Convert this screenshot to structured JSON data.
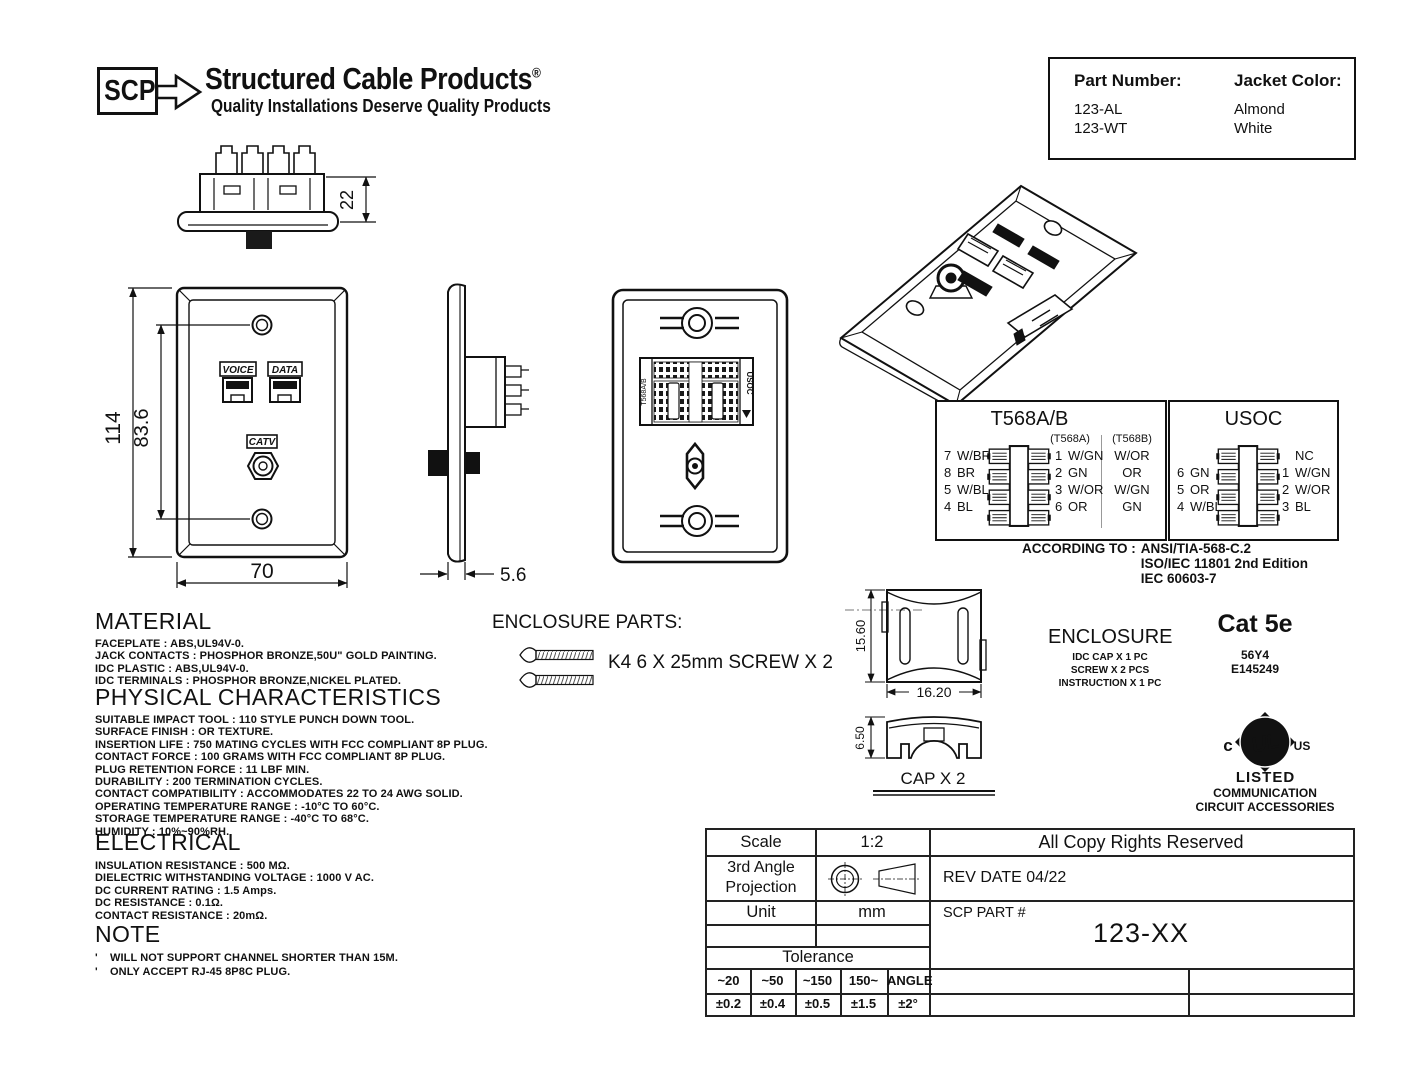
{
  "logo": {
    "abbr": "SCP",
    "title": "Structured Cable Products",
    "registered": "®",
    "tagline": "Quality Installations Deserve Quality Products"
  },
  "part_table": {
    "col1": "Part Number:",
    "col2": "Jacket Color:",
    "rows": [
      {
        "part": "123-AL",
        "color": "Almond"
      },
      {
        "part": "123-WT",
        "color": "White"
      }
    ]
  },
  "dims": {
    "depth": "22",
    "height": "114",
    "screw_spacing": "83.6",
    "width": "70",
    "thickness": "5.6",
    "cap_h": "15.60",
    "cap_w": "16.20",
    "cap_d": "6.50"
  },
  "front_view": {
    "voice": "VOICE",
    "data": "DATA",
    "catv": "CATV"
  },
  "back_view": {
    "left_label": "T568A/B",
    "right_label": "USOC"
  },
  "wiring": {
    "t568": {
      "title": "T568A/B",
      "col_a": "(T568A)",
      "col_b": "(T568B)",
      "left": [
        {
          "n": "7",
          "c": "W/BR"
        },
        {
          "n": "8",
          "c": "BR"
        },
        {
          "n": "5",
          "c": "W/BL"
        },
        {
          "n": "4",
          "c": "BL"
        }
      ],
      "right": [
        {
          "n": "1",
          "a": "W/GN",
          "b": "W/OR"
        },
        {
          "n": "2",
          "a": "GN",
          "b": "OR"
        },
        {
          "n": "3",
          "a": "W/OR",
          "b": "W/GN"
        },
        {
          "n": "6",
          "a": "OR",
          "b": "GN"
        }
      ]
    },
    "usoc": {
      "title": "USOC",
      "left": [
        {
          "n": "6",
          "c": "GN"
        },
        {
          "n": "5",
          "c": "OR"
        },
        {
          "n": "4",
          "c": "W/BL"
        }
      ],
      "right": [
        {
          "n": "",
          "c": "NC"
        },
        {
          "n": "1",
          "c": "W/GN"
        },
        {
          "n": "2",
          "c": "W/OR"
        },
        {
          "n": "3",
          "c": "BL"
        }
      ]
    },
    "according_label": "ACCORDING TO :",
    "standards": [
      "ANSI/TIA-568-C.2",
      "ISO/IEC 11801 2nd Edition",
      "IEC 60603-7"
    ]
  },
  "enclosure_parts": {
    "heading": "ENCLOSURE PARTS:",
    "screw_label": "K4 6 X 25mm SCREW X 2",
    "cap_label": "CAP X 2"
  },
  "enclosure": {
    "title": "ENCLOSURE",
    "items": [
      "IDC CAP X 1 PC",
      "SCREW X 2 PCS",
      "INSTRUCTION X 1 PC"
    ],
    "category": "Cat 5e",
    "code1": "56Y4",
    "code2": "E145249"
  },
  "ul_mark": {
    "c": "c",
    "monogram": "UL",
    "us": "US",
    "listed": "LISTED",
    "line1": "COMMUNICATION",
    "line2": "CIRCUIT ACCESSORIES"
  },
  "material": {
    "heading": "MATERIAL",
    "lines": [
      "FACEPLATE : ABS,UL94V-0.",
      "JACK CONTACTS : PHOSPHOR BRONZE,50U\" GOLD PAINTING.",
      "IDC PLASTIC : ABS,UL94V-0.",
      "IDC TERMINALS : PHOSPHOR BRONZE,NICKEL PLATED."
    ]
  },
  "physical": {
    "heading": "PHYSICAL CHARACTERISTICS",
    "lines": [
      "SUITABLE IMPACT TOOL : 110 STYLE PUNCH DOWN TOOL.",
      "SURFACE FINISH : OR TEXTURE.",
      "INSERTION LIFE : 750 MATING CYCLES WITH FCC COMPLIANT 8P PLUG.",
      "CONTACT FORCE : 100 GRAMS WITH FCC COMPLIANT 8P PLUG.",
      "PLUG RETENTION FORCE : 11 LBF MIN.",
      "DURABILITY : 200 TERMINATION CYCLES.",
      "CONTACT COMPATIBILITY : ACCOMMODATES 22 TO 24 AWG SOLID.",
      "OPERATING TEMPERATURE RANGE : -10°C TO 60°C.",
      "STORAGE TEMPERATURE RANGE : -40°C TO 68°C.",
      "HUMIDITY : 10%~90%RH."
    ]
  },
  "electrical": {
    "heading": "ELECTRICAL",
    "lines": [
      "INSULATION RESISTANCE : 500 MΩ.",
      "DIELECTRIC WITHSTANDING VOLTAGE : 1000 V AC.",
      "DC CURRENT RATING : 1.5 Amps.",
      "DC RESISTANCE : 0.1Ω.",
      "CONTACT RESISTANCE : 20mΩ."
    ]
  },
  "note": {
    "heading": "NOTE",
    "bullet": "'",
    "lines": [
      "WILL NOT SUPPORT CHANNEL SHORTER THAN 15M.",
      "ONLY ACCEPT RJ-45 8P8C PLUG."
    ]
  },
  "title_block": {
    "scale_label": "Scale",
    "scale_value": "1:2",
    "rights": "All Copy Rights Reserved",
    "projection_label": "3rd Angle Projection",
    "rev": "REV DATE 04/22",
    "unit_label": "Unit",
    "unit_value": "mm",
    "part_label": "SCP PART #",
    "part_value": "123-XX",
    "tolerance_label": "Tolerance",
    "tol_headers": [
      "~20",
      "~50",
      "~150",
      "150~",
      "ANGLE"
    ],
    "tol_values": [
      "±0.2",
      "±0.4",
      "±0.5",
      "±1.5",
      "±2°"
    ]
  }
}
